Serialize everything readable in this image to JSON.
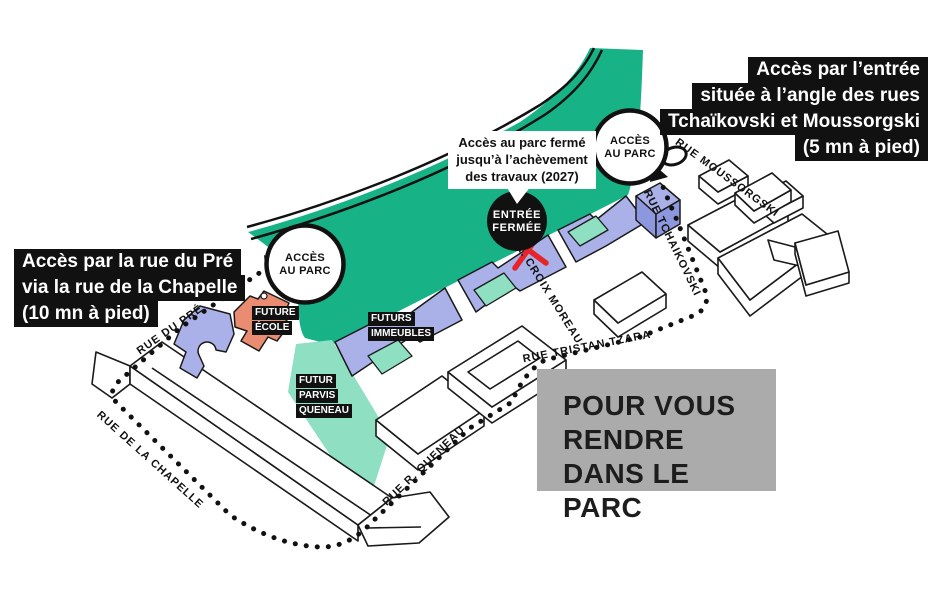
{
  "annotations": {
    "access_left": {
      "line1": "Accès par la rue du Pré",
      "line2": "via la rue de la Chapelle",
      "line3": "(10 mn à pied)"
    },
    "access_right": {
      "line1": "Accès par l’entrée",
      "line2": "située à l’angle des rues",
      "line3": "Tchaïkovski et Moussorgski",
      "line4": "(5 mn à pied)"
    },
    "closed_notice": {
      "line1": "Accès au parc fermé",
      "line2": "jusqu’à l’achèvement",
      "line3": "des travaux (2027)"
    },
    "entree_fermee": {
      "line1": "ENTRÉE",
      "line2": "FERMÉE"
    },
    "acces_parc": {
      "line1": "ACCÈS",
      "line2": "AU PARC"
    },
    "destination": {
      "line1": "POUR VOUS",
      "line2": "RENDRE",
      "line3": "DANS LE PARC"
    }
  },
  "streets": {
    "rue_du_pre": "RUE DU PRÉ",
    "rue_de_la_chapelle": "RUE DE LA CHAPELLE",
    "rue_r_queneau": "RUE R. QUENEAU",
    "rue_tristan_tzara": "RUE TRISTAN TZARA",
    "r_croix_moreau": "R. CROIX MOREAU",
    "rue_tchaikovski": "RUE TCHAIKOVSKI",
    "rue_moussorgski": "RUE MOUSSORGSKI"
  },
  "sites": {
    "future_ecole": {
      "line1": "FUTURE",
      "line2": "ÉCOLE"
    },
    "futurs_immeubles": {
      "line1": "FUTURS",
      "line2": "IMMEUBLES"
    },
    "futur_parvis": {
      "line1": "FUTUR",
      "line2": "PARVIS",
      "line3": "QUENEAU"
    }
  },
  "colors": {
    "park_green": "#17b286",
    "mint": "#8fdfc2",
    "building_blue": "#a9b1e8",
    "building_blue_dark": "#8d97dd",
    "school_orange": "#ea8c71",
    "closed_red": "#e6252b",
    "panel_gray": "#ababab",
    "ink": "#111111"
  }
}
